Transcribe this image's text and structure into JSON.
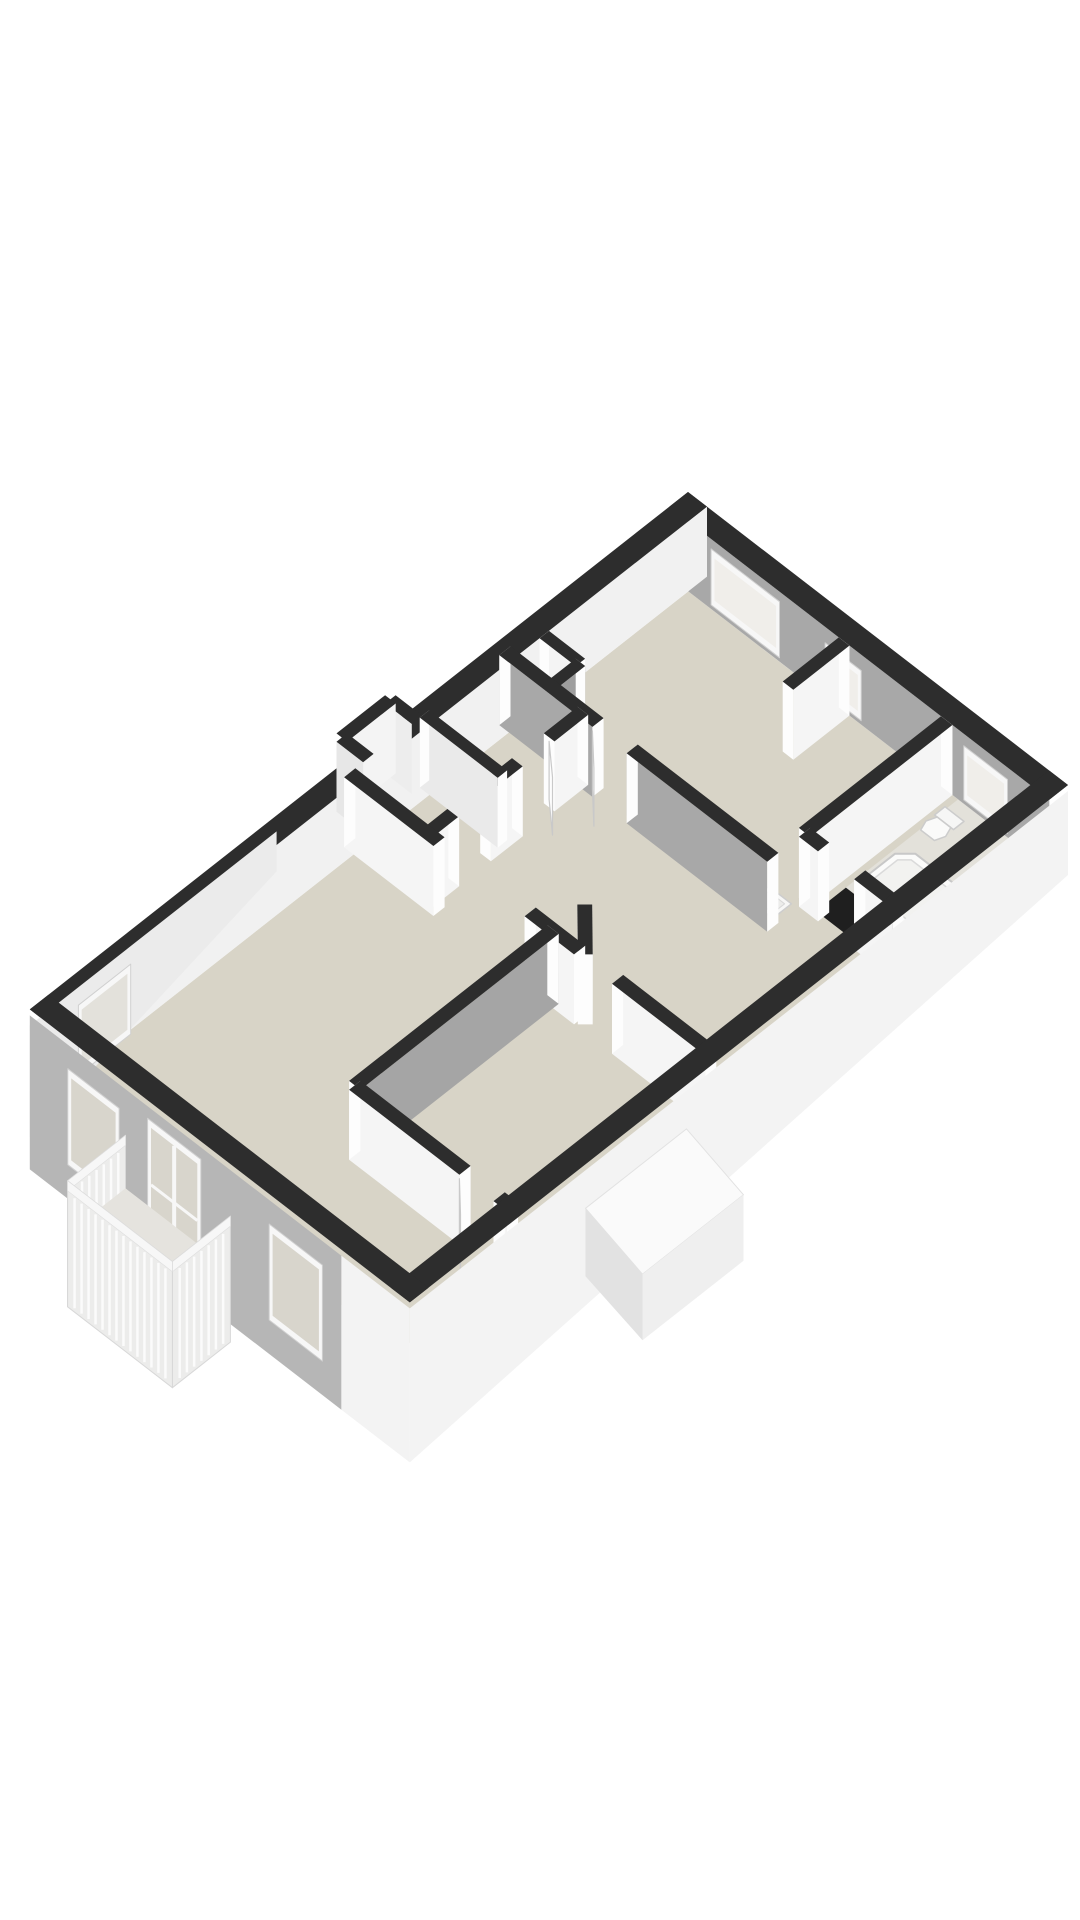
{
  "meta": {
    "kind": "3d-floorplan-render",
    "background": "#ffffff",
    "canvas": {
      "width": 1080,
      "height": 1920
    }
  },
  "palette": {
    "wall_top": "#2d2d2d",
    "cap": "#fdfdfd",
    "window_frame": "#f7f7f7",
    "window_glass_interior": "#f0eeea",
    "window_glass_facade": "#d8d5cc",
    "window_glass_outer": "#e3e1db",
    "leaf_fill": "#fdfdfd",
    "leaf_stroke": "#c9c9c9",
    "railing_fill": "#ececeb",
    "railing_stroke": "#d8d8d8",
    "railing_slat": "#fbfbfb",
    "railing_toprail": "#f7f7f7"
  },
  "projection": {
    "origin": [
      688,
      492
    ],
    "eu": [
      38.0,
      29.3
    ],
    "ev": [
      -37.4,
      29.4
    ],
    "floor_drop": 70
  },
  "elements": [
    {
      "type": "poly",
      "name": "floor-main",
      "fill": "#d8d4c7",
      "pts": [
        [
          0.5,
          0.5,
          70
        ],
        [
          9.5,
          0.5,
          70
        ],
        [
          9.5,
          17.35,
          70
        ],
        [
          0.5,
          17.35,
          70
        ]
      ]
    },
    {
      "type": "poly",
      "name": "floor-bathroom",
      "fill": "#e3e1da",
      "pts": [
        [
          7.6,
          0.5,
          70
        ],
        [
          9.5,
          0.5,
          70
        ],
        [
          9.5,
          4.3,
          70
        ],
        [
          7.6,
          4.3,
          70
        ]
      ]
    },
    {
      "type": "poly",
      "name": "bathroom-plinth",
      "fill": "#1f1f1f",
      "pts": [
        [
          7.6,
          3.5,
          70
        ],
        [
          9.5,
          3.5,
          70
        ],
        [
          9.5,
          4.3,
          70
        ],
        [
          7.6,
          4.3,
          70
        ]
      ]
    },
    {
      "type": "wall",
      "name": "wall-ne",
      "a": [
        0,
        0.25
      ],
      "b": [
        10,
        0.25
      ],
      "t": 0.5,
      "face_offset": 1,
      "face": "#a8a8a8",
      "caps": false
    },
    {
      "type": "window",
      "name": "window-ne-1",
      "a": [
        1.1,
        0.5
      ],
      "b": [
        2.9,
        0.5
      ],
      "top": 10,
      "bottom": 66,
      "glass": "#f0eeea"
    },
    {
      "type": "window",
      "name": "window-ne-2",
      "a": [
        4.1,
        0.5
      ],
      "b": [
        5.05,
        0.5
      ],
      "top": 16,
      "bottom": 66,
      "glass": "#f0eeea"
    },
    {
      "type": "window",
      "name": "window-ne-bath",
      "a": [
        7.75,
        0.5
      ],
      "b": [
        8.9,
        0.5
      ],
      "top": 12,
      "bottom": 66,
      "glass": "#f0eeea"
    },
    {
      "type": "wall",
      "name": "wall-nw",
      "a": [
        0.25,
        0
      ],
      "b": [
        0.25,
        17.6
      ],
      "t": 0.5,
      "face_offset": -1,
      "face": "#f1f1f1",
      "caps": false
    },
    {
      "type": "wall",
      "name": "bay-nw-back",
      "a": [
        -0.45,
        7.5
      ],
      "b": [
        0.25,
        7.5
      ],
      "t": 0.28,
      "face_offset": 1,
      "face": "#ededed",
      "caps": false
    },
    {
      "type": "wall",
      "name": "bay-nw-side",
      "a": [
        -0.45,
        7.5
      ],
      "b": [
        -0.45,
        8.8
      ],
      "t": 0.28,
      "face_offset": -1,
      "face": "#f4f4f4",
      "caps": false
    },
    {
      "type": "wall",
      "name": "bay-nw-front",
      "a": [
        -0.45,
        8.8
      ],
      "b": [
        0.25,
        8.8
      ],
      "t": 0.28,
      "face_offset": 1,
      "face": "#e7e7e7",
      "caps": false
    },
    {
      "type": "wall",
      "name": "closet-niche-back",
      "a": [
        0.5,
        4.35
      ],
      "b": [
        1.45,
        4.35
      ],
      "t": 0.25,
      "face_offset": 1,
      "face": "#f4f4f4",
      "caps": true
    },
    {
      "type": "wall",
      "name": "closet-niche-side",
      "a": [
        1.45,
        4.35
      ],
      "b": [
        1.45,
        5.15
      ],
      "t": 0.25,
      "face_offset": -1,
      "face": "#9e9e9e",
      "caps": true
    },
    {
      "type": "wall",
      "name": "stub-bedroom1",
      "a": [
        4.6,
        0.5
      ],
      "b": [
        4.6,
        2.0
      ],
      "t": 0.28,
      "face_offset": -1,
      "face": "#f5f5f5",
      "caps": true
    },
    {
      "type": "wall",
      "name": "wall-bed1-bath",
      "a": [
        7.3,
        0.5
      ],
      "b": [
        7.3,
        4.3
      ],
      "t": 0.3,
      "face_offset": -1,
      "face": "#f5f5f5",
      "caps": true
    },
    {
      "type": "poly",
      "name": "bathtub-outer",
      "fill": "#fbfbfa",
      "stroke": "#c8c8c8",
      "sw": 2,
      "pts": [
        [
          7.95,
          2.0,
          70
        ],
        [
          9.15,
          2.0,
          70
        ],
        [
          9.42,
          2.27,
          70
        ],
        [
          9.42,
          3.13,
          70
        ],
        [
          9.15,
          3.4,
          70
        ],
        [
          7.95,
          3.4,
          70
        ],
        [
          7.68,
          3.13,
          70
        ],
        [
          7.68,
          2.27,
          70
        ]
      ]
    },
    {
      "type": "poly",
      "name": "bathtub-inner",
      "fill": "#f2f2f0",
      "stroke": "#dadada",
      "sw": 1.5,
      "pts": [
        [
          8.0,
          2.16,
          70
        ],
        [
          9.1,
          2.16,
          70
        ],
        [
          9.28,
          2.34,
          70
        ],
        [
          9.28,
          3.06,
          70
        ],
        [
          9.1,
          3.24,
          70
        ],
        [
          8.0,
          3.24,
          70
        ],
        [
          7.82,
          3.06,
          70
        ],
        [
          7.82,
          2.34,
          70
        ]
      ]
    },
    {
      "type": "circle",
      "name": "bathtub-faucet",
      "c": [
        9.2,
        2.08,
        70
      ],
      "r": 4,
      "fill": "#d5d5d5"
    },
    {
      "type": "poly",
      "name": "toilet-tank",
      "fill": "#f6f6f5",
      "stroke": "#cccccc",
      "sw": 1.5,
      "pts": [
        [
          7.55,
          0.8,
          70
        ],
        [
          8.05,
          0.8,
          70
        ],
        [
          8.05,
          1.08,
          70
        ],
        [
          7.55,
          1.08,
          70
        ]
      ]
    },
    {
      "type": "poly",
      "name": "toilet-bowl",
      "fill": "#fafaf9",
      "stroke": "#cccccc",
      "sw": 1.5,
      "pts": [
        [
          7.62,
          1.08,
          70
        ],
        [
          7.98,
          1.08,
          70
        ],
        [
          8.06,
          1.3,
          70
        ],
        [
          7.98,
          1.52,
          70
        ],
        [
          7.62,
          1.52,
          70
        ],
        [
          7.54,
          1.3,
          70
        ]
      ]
    },
    {
      "type": "wall",
      "name": "wall-bath-sw",
      "a": [
        7.3,
        4.3
      ],
      "b": [
        9.75,
        4.3
      ],
      "t": 0.3,
      "face_offset": 1,
      "face": "#f5f5f5",
      "caps": true,
      "gaps": [
        [
          0.5,
          1.45
        ]
      ]
    },
    {
      "type": "poly",
      "name": "sink",
      "fill": "#f7f7f6",
      "stroke": "#cdcdcd",
      "sw": 1.5,
      "pts": [
        [
          6.55,
          4.5,
          70
        ],
        [
          7.15,
          4.5,
          70
        ],
        [
          7.15,
          5.0,
          70
        ],
        [
          6.55,
          5.0,
          70
        ]
      ]
    },
    {
      "type": "poly",
      "name": "sink-basin",
      "fill": "#ececea",
      "stroke": "#d8d8d8",
      "sw": 1,
      "pts": [
        [
          6.64,
          4.59,
          70
        ],
        [
          7.06,
          4.59,
          70
        ],
        [
          7.06,
          4.91,
          70
        ],
        [
          6.64,
          4.91,
          70
        ]
      ]
    },
    {
      "type": "wall",
      "name": "wall-bed1-sw",
      "a": [
        0.25,
        5.15
      ],
      "b": [
        7.3,
        5.15
      ],
      "t": 0.3,
      "face_offset": 1,
      "face": "#a8a8a8",
      "caps": true,
      "gaps": [
        [
          2.45,
          3.35
        ]
      ]
    },
    {
      "type": "leaf",
      "name": "door-bedroom1",
      "a": [
        2.7,
        5.3
      ],
      "b": [
        3.35,
        5.92
      ]
    },
    {
      "type": "wall",
      "name": "wall-closets",
      "a": [
        2.3,
        5.15
      ],
      "b": [
        2.3,
        9.3
      ],
      "t": 0.28,
      "face_offset": -1,
      "face": "#f5f5f5",
      "caps": true,
      "gaps": [
        [
          0.9,
          1.75
        ],
        [
          2.6,
          3.45
        ]
      ]
    },
    {
      "type": "wall",
      "name": "wall-closet-div",
      "a": [
        0.25,
        7.3
      ],
      "b": [
        2.3,
        7.3
      ],
      "t": 0.25,
      "face_offset": 1,
      "face": "#eaeaea",
      "caps": true
    },
    {
      "type": "leaf",
      "name": "door-closet",
      "a": [
        2.3,
        6.05
      ],
      "b": [
        2.95,
        6.62
      ]
    },
    {
      "type": "wall",
      "name": "wall-diagonal",
      "a": [
        5.6,
        8.45
      ],
      "b": [
        6.45,
        9.3
      ],
      "t": 0.28,
      "face_offset": -1,
      "face": "#efefef",
      "caps": true
    },
    {
      "type": "wall",
      "name": "wall-living-n",
      "a": [
        0.25,
        9.3
      ],
      "b": [
        9.75,
        9.3
      ],
      "t": 0.3,
      "face_offset": 1,
      "face": "#f5f5f5",
      "caps": true,
      "gaps": [
        [
          2.35,
          4.75
        ],
        [
          6.05,
          7.05
        ]
      ]
    },
    {
      "type": "wall",
      "name": "wall-vestibule",
      "a": [
        5.6,
        9.3
      ],
      "b": [
        5.6,
        14.6
      ],
      "t": 0.3,
      "face_offset": -1,
      "face": "#a5a5a5",
      "caps": true
    },
    {
      "type": "wall",
      "name": "wall-bed2-n",
      "a": [
        5.6,
        14.6
      ],
      "b": [
        9.75,
        14.6
      ],
      "t": 0.3,
      "face_offset": 1,
      "face": "#f5f5f5",
      "caps": true,
      "gaps": [
        [
          2.9,
          3.8
        ]
      ]
    },
    {
      "type": "leaf",
      "name": "door-bedroom2",
      "a": [
        8.5,
        14.75
      ],
      "b": [
        9.12,
        15.35
      ]
    },
    {
      "type": "poly",
      "name": "facade-nw-outer",
      "fill": "#ebebeb",
      "pts": [
        [
          0,
          11.0,
          16
        ],
        [
          0,
          17.6,
          16
        ],
        [
          0,
          17.6,
          128
        ],
        [
          0,
          11.0,
          56
        ]
      ]
    },
    {
      "type": "window",
      "name": "window-nw",
      "a": [
        0,
        14.9
      ],
      "b": [
        0,
        16.3
      ],
      "top": 34,
      "bottom": 104,
      "glass": "#e3e1db"
    },
    {
      "type": "poly",
      "name": "facade-se",
      "fill": "#f3f3f3",
      "pts": [
        [
          10,
          0,
          6
        ],
        [
          10,
          17.6,
          6
        ],
        [
          10,
          17.6,
          160
        ],
        [
          10,
          0,
          90
        ]
      ]
    },
    {
      "type": "wall",
      "name": "wall-se",
      "a": [
        9.75,
        0
      ],
      "b": [
        9.75,
        17.6
      ],
      "t": 0.5,
      "face_offset": -1,
      "face": null,
      "caps": false
    },
    {
      "type": "poly",
      "name": "stair-bulge-top",
      "fill": "#fafafa",
      "stroke": "#e2e2e2",
      "sw": 1,
      "pts": [
        [
          10,
          10.2,
          44
        ],
        [
          11.5,
          10.2,
          66
        ],
        [
          11.5,
          12.9,
          66
        ],
        [
          10,
          12.9,
          44
        ]
      ]
    },
    {
      "type": "poly",
      "name": "stair-bulge-front",
      "fill": "#e2e2e2",
      "pts": [
        [
          10,
          12.9,
          44
        ],
        [
          11.5,
          12.9,
          66
        ],
        [
          11.5,
          12.9,
          132
        ],
        [
          10,
          12.9,
          112
        ]
      ]
    },
    {
      "type": "poly",
      "name": "stair-bulge-side",
      "fill": "#efefef",
      "pts": [
        [
          11.5,
          10.2,
          66
        ],
        [
          11.5,
          12.9,
          66
        ],
        [
          11.5,
          12.9,
          132
        ],
        [
          11.5,
          10.2,
          132
        ]
      ]
    },
    {
      "type": "poly",
      "name": "facade-sw-gray",
      "fill": "#b6b6b6",
      "pts": [
        [
          0,
          17.6,
          6
        ],
        [
          8.2,
          17.6,
          6
        ],
        [
          8.2,
          17.6,
          160
        ],
        [
          0,
          17.6,
          160
        ]
      ]
    },
    {
      "type": "poly",
      "name": "facade-sw-white",
      "fill": "#f3f3f3",
      "pts": [
        [
          8.2,
          17.6,
          6
        ],
        [
          10,
          17.6,
          6
        ],
        [
          10,
          17.6,
          160
        ],
        [
          8.2,
          17.6,
          160
        ]
      ]
    },
    {
      "type": "wall",
      "name": "wall-sw",
      "a": [
        0,
        17.35
      ],
      "b": [
        10,
        17.35
      ],
      "t": 0.5,
      "face_offset": 1,
      "face": null,
      "caps": false
    },
    {
      "type": "window",
      "name": "window-sw-1",
      "a": [
        1.0,
        17.6
      ],
      "b": [
        2.35,
        17.6
      ],
      "top": 30,
      "bottom": 126,
      "glass": "#d8d5cc"
    },
    {
      "type": "window",
      "name": "door-french",
      "a": [
        3.1,
        17.6
      ],
      "b": [
        4.5,
        17.6
      ],
      "top": 18,
      "bottom": 154,
      "glass": "#d8d5cc",
      "mullion": true
    },
    {
      "type": "window",
      "name": "window-sw-2",
      "a": [
        6.3,
        17.6
      ],
      "b": [
        7.7,
        17.6
      ],
      "top": 30,
      "bottom": 126,
      "glass": "#d8d5cc"
    },
    {
      "type": "railing",
      "name": "balcony-railing-left",
      "a": [
        2.52,
        17.6
      ],
      "b": [
        2.52,
        19.15
      ],
      "top": 52,
      "bottom": 178,
      "slats": 8
    },
    {
      "type": "poly",
      "name": "balcony-floor",
      "fill": "#e5e3de",
      "pts": [
        [
          2.52,
          17.6,
          105
        ],
        [
          5.28,
          17.6,
          105
        ],
        [
          5.28,
          19.15,
          105
        ],
        [
          2.52,
          19.15,
          105
        ]
      ]
    },
    {
      "type": "railing",
      "name": "balcony-railing-right",
      "a": [
        5.28,
        17.6
      ],
      "b": [
        5.28,
        19.15
      ],
      "top": 52,
      "bottom": 178,
      "slats": 8
    },
    {
      "type": "railing",
      "name": "balcony-railing-front",
      "a": [
        2.52,
        19.15
      ],
      "b": [
        5.28,
        19.15
      ],
      "top": 52,
      "bottom": 178,
      "slats": 15
    }
  ]
}
